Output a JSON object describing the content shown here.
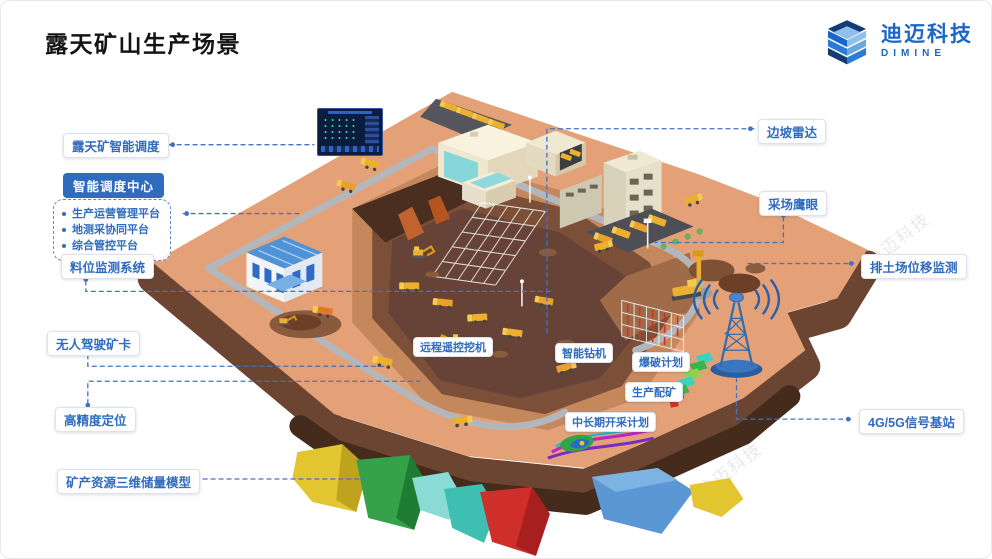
{
  "title": "露天矿山生产场景",
  "logo": {
    "brand_cn": "迪迈科技",
    "brand_en": "DIMINE"
  },
  "watermark_text": "迪迈科技",
  "dispatch_center": {
    "title": "智能调度中心",
    "items": [
      "生产运营管理平台",
      "地测采协同平台",
      "综合管控平台"
    ]
  },
  "callouts": {
    "open_pit_dispatch": "露天矿智能调度",
    "material_level": "料位监测系统",
    "unmanned_truck": "无人驾驶矿卡",
    "high_precision": "高精度定位",
    "resource_model": "矿产资源三维储量模型",
    "slope_radar": "边坡雷达",
    "eagle_eye": "采场鹰眼",
    "dump_displacement": "排土场位移监测",
    "base_station": "4G/5G信号基站",
    "remote_excavator": "远程遥控挖机",
    "smart_drill": "智能钻机",
    "blast_plan": "爆破计划",
    "ore_blending": "生产配矿",
    "mining_plan": "中长期开采计划"
  },
  "colors": {
    "accent_blue": "#2f6bbf",
    "logo_blue": "#1b66c9",
    "connector": "#4472c4",
    "terrain": "#e4a177",
    "pit_floor": "#664336",
    "machine_yellow": "#edb02e",
    "geo_block_palette": [
      "#e3c52f",
      "#35a24a",
      "#3fbfb2",
      "#cf2f2b",
      "#5b97d4"
    ]
  }
}
